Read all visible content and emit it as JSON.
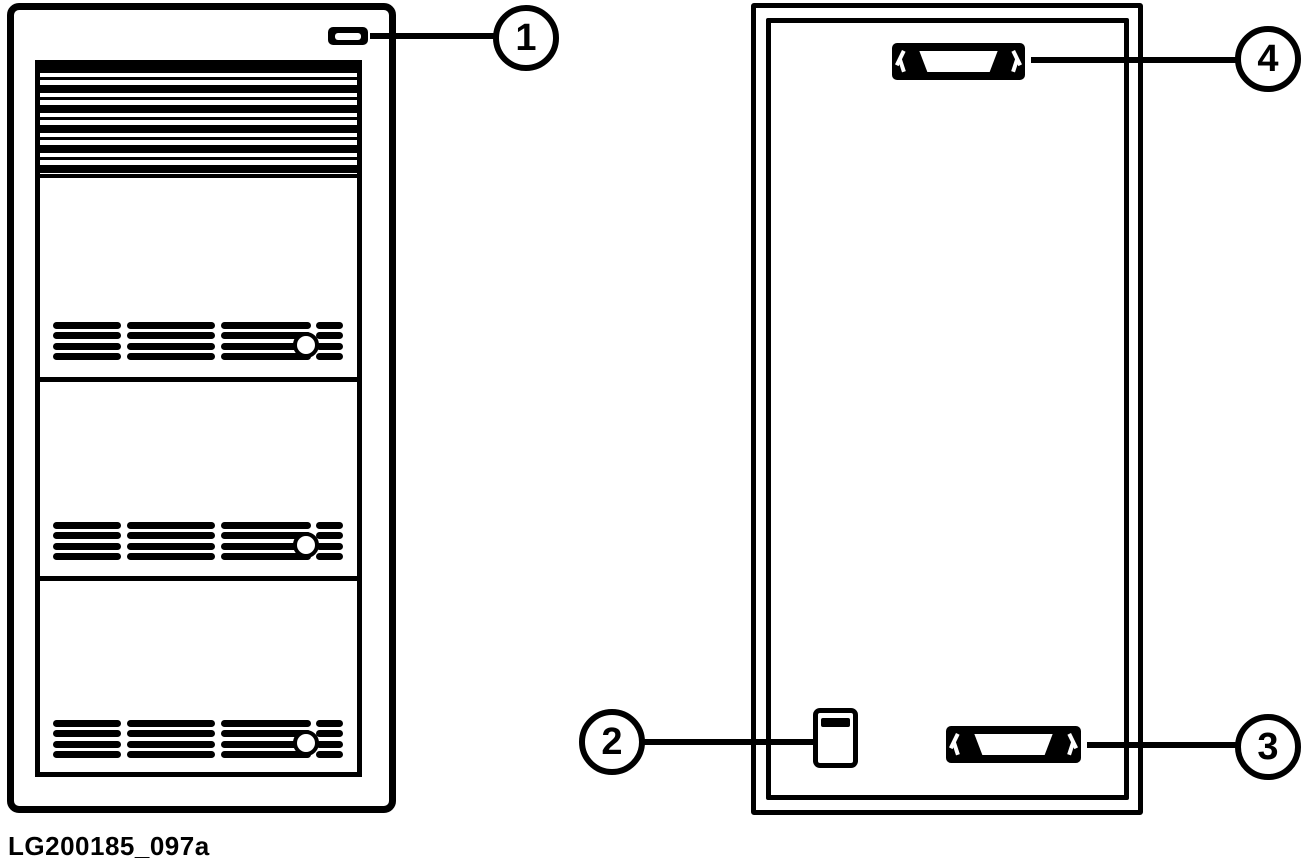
{
  "figure": {
    "caption": "LG200185_097a",
    "colors": {
      "line": "#000000",
      "background": "#ffffff"
    },
    "views": {
      "left": "tower-front-view",
      "right": "side-panel-view"
    },
    "callouts": [
      {
        "number": "1",
        "points_to": "power-button"
      },
      {
        "number": "2",
        "points_to": "slide-switch"
      },
      {
        "number": "3",
        "points_to": "bottom-connector"
      },
      {
        "number": "4",
        "points_to": "top-connector"
      }
    ]
  }
}
